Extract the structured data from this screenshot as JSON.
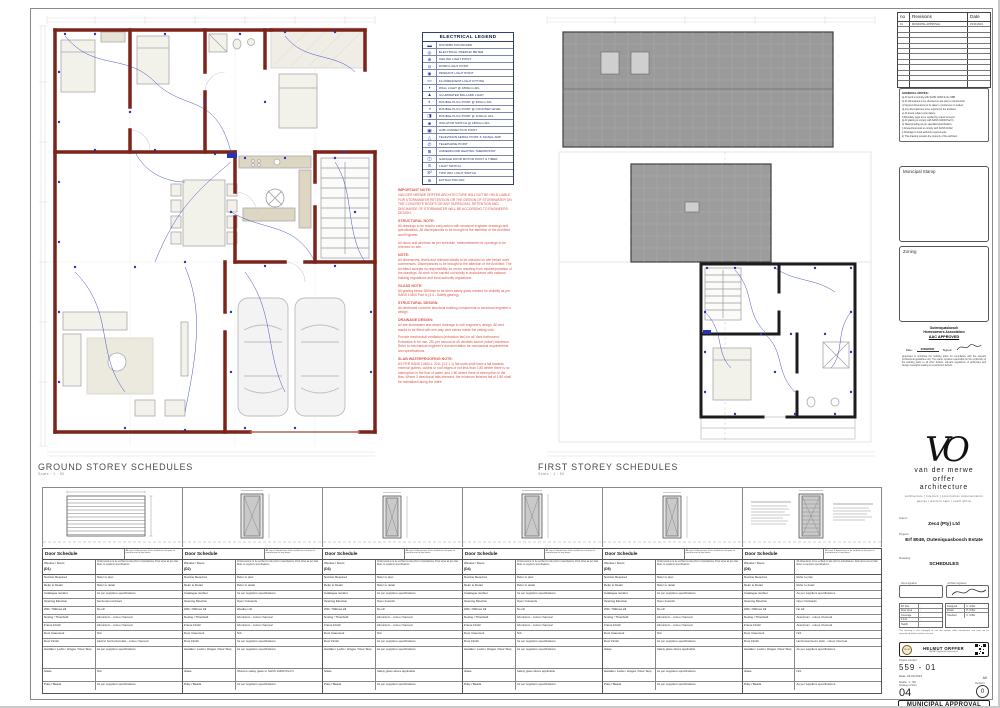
{
  "plans": {
    "ground_title": "GROUND STOREY SCHEDULES",
    "ground_scale": "Scale : 1 : 50",
    "first_title": "FIRST STOREY SCHEDULES",
    "first_scale": "Scale : 1 : 50"
  },
  "legend": {
    "title": "ELECTRICAL LEGEND",
    "rows": [
      {
        "glyph": "▬",
        "label": "DISTRIBUTION BOARD"
      },
      {
        "glyph": "◎",
        "label": "ELECTRICAL PREPAID METER"
      },
      {
        "glyph": "⊕",
        "label": "CEILING LIGHT POINT"
      },
      {
        "glyph": "⊙",
        "label": "DOWN LIGHT POINT"
      },
      {
        "glyph": "◉",
        "label": "PENDANT LIGHT POINT"
      },
      {
        "glyph": "▭",
        "label": "FLUORESCENT LIGHT FITTING"
      },
      {
        "glyph": "◖",
        "label": "WALL LIGHT @ 1800mm AFL"
      },
      {
        "glyph": "▲",
        "label": "ILLUMINATED BOLLARD LIGHT"
      },
      {
        "glyph": "◐",
        "label": "DOUBLE PLUG POINT @ 300mm AFL"
      },
      {
        "glyph": "◑",
        "label": "DOUBLE PLUG POINT @ COUNTER LEVEL"
      },
      {
        "glyph": "◨",
        "label": "DOUBLE PLUG POINT @ 1100mm AFL"
      },
      {
        "glyph": "■",
        "label": "ISOLATOR SWITCH @ 1800mm AFL"
      },
      {
        "glyph": "▣",
        "label": "HOB CONNECTION POINT"
      },
      {
        "glyph": "△",
        "label": "TELEVISION AERIAL POINT & SIGNAL AMP"
      },
      {
        "glyph": "✆",
        "label": "TELEPHONE POINT"
      },
      {
        "glyph": "⊞",
        "label": "UNDERFLOOR HEATING THERMOSTAT"
      },
      {
        "glyph": "◫",
        "label": "GARAGE DOOR MOTOR POINT & TIMER"
      },
      {
        "glyph": "S",
        "label": "LIGHT SWITCH"
      },
      {
        "glyph": "S²",
        "label": "TWO WAY LIGHT SWITCH"
      },
      {
        "glyph": "⊛",
        "label": "EXTRACTOR FAN"
      }
    ]
  },
  "notes": {
    "sections": [
      {
        "heading": "IMPORTANT NOTE:",
        "body": "VAN DER MERWE ORFFER ARCHITECTURE WILL NOT BE HELD LIABLE FOR STORMWATER RETENTION OR THE DESIGN OF STORMWATER ON THE CONCRETE ROOFS OR ANY SURFACING, RETENTION AND DISCHARGE OF STORMWATER WILL BE ACCORDING TO ENGINEERS DESIGN."
      },
      {
        "heading": "STRUCTURAL NOTE:",
        "body": "All drawings to be read in conjunction with structural engineer drawings and specifications. All discrepancies to be brought to the attention of the Architect and Engineer."
      },
      {
        "heading": "",
        "body": "All doors and windows as per schedule, measurements for openings to be checked on site."
      },
      {
        "heading": "NOTE:",
        "body": "All dimensions, levels and relevant details to be checked on site before work commences. Discrepancies to be brought to the attention of the Architect. The Architect accepts no responsibility for errors resulting from misinterpretation of the drawings. All work to be carried out strictly in accordance with national building regulations and local authority regulations."
      },
      {
        "heading": "GLASS NOTE:",
        "body": "All glazing below 1800mm to be 6mm safety glass marked for visibility as per SANS 10400 Part N (4.4 - Safety glazing)."
      },
      {
        "heading": "STRUCTURAL DESIGN:",
        "body": "All reinforced concrete structural building components to structural engineer's design."
      },
      {
        "heading": "DRAINAGE DESIGN:",
        "body": "All site stormwater and sewer drainage to civil engineer's design. All vent stacks to be fitted with one-way vent valves inside the ceiling void."
      },
      {
        "heading": "",
        "body": "Provide mechanical ventilation (extraction fan) for all 'dark bathrooms'. Extraction to be min. 25L per second at 45 decibels sound (noise) maximum. Refer to mechanical engineer's documentation for mechanical requirements and specifications."
      },
      {
        "heading": "SLAB WATERPROOFING NOTE:",
        "body": "AS PER SANS 10400-L 2011 (4.2.1.1) flat roofs shall have a fall towards external gutters, outlets or roof edges of not less than 1:80 where there is no interruption in the flow of water, and 1:50 where there is interruption in the flow. Where 2 directional falls intersect, the minimum finished fall of 1:80 shall be maintained along the mitre."
      }
    ]
  },
  "doors": [
    {
      "title": "Door Schedule",
      "code": "(D1)",
      "title_note": "All sizes & dimensions to be verified on site prior to manufacture of any doors.",
      "window_label": "Window / Doors",
      "note": "All dimensions to be verified on site prior to manufacture. Door sizes as per plan. Refer to suppliers specifications.",
      "rows": [
        {
          "l": "Number Required",
          "v": "Refer to plan"
        },
        {
          "l": "Refer to Detail",
          "v": "Refer to detail"
        },
        {
          "l": "Catalogue number",
          "v": "As per suppliers specifications"
        },
        {
          "l": "Opening Direction",
          "v": "Sectional overhead"
        },
        {
          "l": "With / Without sill",
          "v": "No sill"
        },
        {
          "l": "Nosing / Threshold",
          "v": "Aluminium - colour charcoal"
        },
        {
          "l": "Frame Finish",
          "v": "Aluminium - colour charcoal"
        },
        {
          "l": "Door Casement",
          "v": "N/A"
        },
        {
          "l": "Door Finish",
          "v": "Aluzinc horizontal slats - colour charcoal"
        },
        {
          "l": "Handles / Locks / Hinges / Door Stop",
          "v": "As per suppliers specifications"
        },
        {
          "l": "Glass",
          "v": "N/A"
        },
        {
          "l": "Putty / Beads",
          "v": "As per suppliers specifications"
        }
      ]
    },
    {
      "title": "Door Schedule",
      "code": "(D2)",
      "title_note": "All sizes & dimensions to be verified on site prior to manufacture of any doors.",
      "window_label": "Window / Doors",
      "note": "All dimensions to be verified on site prior to manufacture. Door sizes as per plan. Refer to suppliers specifications.",
      "rows": [
        {
          "l": "Number Required",
          "v": "Refer to plan"
        },
        {
          "l": "Refer to Detail",
          "v": "Refer to detail"
        },
        {
          "l": "Catalogue number",
          "v": "As per suppliers specifications"
        },
        {
          "l": "Opening Direction",
          "v": "Open Outwards"
        },
        {
          "l": "With / Without sill",
          "v": "Weather sill"
        },
        {
          "l": "Nosing / Threshold",
          "v": "Aluminium - colour charcoal"
        },
        {
          "l": "Frame Finish",
          "v": "Aluminium - colour charcoal"
        },
        {
          "l": "Door Casement",
          "v": "N/A"
        },
        {
          "l": "Door Finish",
          "v": "As per suppliers specifications"
        },
        {
          "l": "Handles / Locks / Hinges / Door Stop",
          "v": "As per suppliers specifications"
        },
        {
          "l": "Glass",
          "v": "Obscure safety glass to SANS 10400 Part N"
        },
        {
          "l": "Putty / Beads",
          "v": "As per suppliers specifications"
        }
      ]
    },
    {
      "title": "Door Schedule",
      "code": "(D3)",
      "title_note": "All sizes & dimensions to be verified on site prior to manufacture of any doors.",
      "window_label": "Window / Doors",
      "note": "All dimensions to be verified on site prior to manufacture. Door sizes as per plan. Refer to suppliers specifications.",
      "rows": [
        {
          "l": "Number Required",
          "v": "Refer to plan"
        },
        {
          "l": "Refer to Detail",
          "v": "Refer to detail"
        },
        {
          "l": "Catalogue number",
          "v": "As per suppliers specifications"
        },
        {
          "l": "Opening Direction",
          "v": "Open Inwards"
        },
        {
          "l": "With / Without sill",
          "v": "No sill"
        },
        {
          "l": "Nosing / Threshold",
          "v": "Aluminium - colour charcoal"
        },
        {
          "l": "Frame Finish",
          "v": "Aluminium - colour charcoal"
        },
        {
          "l": "Door Casement",
          "v": "N/A"
        },
        {
          "l": "Door Finish",
          "v": "As per suppliers specifications"
        },
        {
          "l": "Handles / Locks / Hinges / Door Stop",
          "v": "As per suppliers specifications"
        },
        {
          "l": "Glass",
          "v": "Safety glass where applicable"
        },
        {
          "l": "Putty / Beads",
          "v": "As per suppliers specifications"
        }
      ]
    },
    {
      "title": "Door Schedule",
      "code": "(D4)",
      "title_note": "All sizes & dimensions to be verified on site prior to manufacture of any doors.",
      "window_label": "Window / Doors",
      "note": "All dimensions to be verified on site prior to manufacture. Door sizes as per plan. Refer to suppliers specifications.",
      "rows": [
        {
          "l": "Number Required",
          "v": "Refer to plan"
        },
        {
          "l": "Refer to Detail",
          "v": "Refer to detail"
        },
        {
          "l": "Catalogue number",
          "v": "As per suppliers specifications"
        },
        {
          "l": "Opening Direction",
          "v": "Open Outwards"
        },
        {
          "l": "With / Without sill",
          "v": "No sill"
        },
        {
          "l": "Nosing / Threshold",
          "v": "Aluminium - colour charcoal"
        },
        {
          "l": "Frame Finish",
          "v": "Aluminium - colour charcoal"
        },
        {
          "l": "Door Casement",
          "v": "N/A"
        },
        {
          "l": "Door Finish",
          "v": "As per suppliers specifications"
        },
        {
          "l": "Handles / Locks / Hinges / Door Stop",
          "v": "As per suppliers specifications"
        },
        {
          "l": "Glass",
          "v": "Safety glass where applicable"
        },
        {
          "l": "Putty / Beads",
          "v": "As per suppliers specifications"
        }
      ]
    },
    {
      "title": "Door Schedule",
      "code": "(D5)",
      "title_note": "All sizes & dimensions to be verified on site prior to manufacture of any doors.",
      "window_label": "Window / Doors",
      "note": "All dimensions to be verified on site prior to manufacture. Door sizes as per plan. Refer to suppliers specifications.",
      "rows": [
        {
          "l": "Number Required",
          "v": "Refer to plan"
        },
        {
          "l": "Refer to Detail",
          "v": "Refer to detail"
        },
        {
          "l": "Catalogue number",
          "v": "As per suppliers specifications"
        },
        {
          "l": "Opening Direction",
          "v": "Open Inwards"
        },
        {
          "l": "With / Without sill",
          "v": "No sill"
        },
        {
          "l": "Nosing / Threshold",
          "v": "Aluminium - colour charcoal"
        },
        {
          "l": "Frame Finish",
          "v": "Aluminium - colour charcoal"
        },
        {
          "l": "Door Casement",
          "v": "N/A"
        },
        {
          "l": "Door Finish",
          "v": "As per suppliers specifications"
        },
        {
          "l": "Glass",
          "v": "Safety glass where applicable"
        },
        {
          "l": "Handles / Locks / Hinges / Door Stop",
          "v": "As per suppliers specifications"
        },
        {
          "l": "Putty / Beads",
          "v": "As per suppliers specifications"
        }
      ]
    },
    {
      "title": "Door Schedule",
      "code": "(D6)",
      "title_note": "All sizes & dimensions to be verified on site prior to manufacture of any doors.",
      "window_label": "Window / Doors",
      "note": "All dimensions to be verified on site prior to manufacture. Door sizes as per plan. Refer to suppliers specifications.",
      "rows": [
        {
          "l": "Number Required",
          "v": "Refer to plan"
        },
        {
          "l": "Refer to Detail",
          "v": "Refer to detail"
        },
        {
          "l": "Catalogue number",
          "v": "As per suppliers specifications"
        },
        {
          "l": "Opening Direction",
          "v": "Open Outwards"
        },
        {
          "l": "With / Without sill",
          "v": "No sill"
        },
        {
          "l": "Nosing / Threshold",
          "v": "Aluminium - colour charcoal"
        },
        {
          "l": "Frame Finish",
          "v": "Aluminium - colour charcoal"
        },
        {
          "l": "Door Casement",
          "v": "N/A"
        },
        {
          "l": "Door Finish",
          "v": "Horizontal louvre slats - colour charcoal"
        },
        {
          "l": "Handles / Locks / Hinges / Door Stop",
          "v": "As per suppliers specifications"
        },
        {
          "l": "Glass",
          "v": "N/A"
        },
        {
          "l": "Putty / Beads",
          "v": "As per suppliers specifications"
        }
      ]
    }
  ],
  "titleblock": {
    "revisions": {
      "no_h": "no",
      "rev_h": "Revisions",
      "date_h": "Date",
      "rows": [
        {
          "no": "01",
          "rev": "MUNICIPAL APPROVAL",
          "date": "23.09.2021"
        }
      ],
      "empty_rows": [
        "",
        "",
        "",
        "",
        "",
        "",
        "",
        "",
        "",
        "",
        ""
      ]
    },
    "general_notes_heading": "GENERAL NOTES:",
    "general_notes": [
      "a) All work to comply with SANS 10400 & the NBR.",
      "b) All dimensions to be checked on site prior to construction.",
      "c) Figured dimensions to be taken in preference to scaled.",
      "d) Any discrepancies to be reported to the architect.",
      "e) All levels relate to site datum.",
      "f) Boundary pegs to be verified by a land surveyor.",
      "g) All glazing to comply with SANS 10400 Part N.",
      "h) Waterproofing as per specialist specification.",
      "i) All electrical work to comply with SANS 10142.",
      "j) Drainage to local authority requirements.",
      "k) This drawing remains the property of the architect."
    ],
    "municipal_stamp_label": "Municipal Stamp",
    "zoning_label": "Zoning",
    "hoa": {
      "line1": "Outeniquasbosch",
      "line2": "Homeowners Association",
      "line3": "AAC APPROVED",
      "date_label": "Date:",
      "date": "23/09/2021",
      "signed_label": "Signed:",
      "disclaimer": "Appointed to scrutinise the building plans for compliance with the relevant architectural guidelines only. The owner remains responsible for the conformity of the building plans to all other bylaws, relevant regulations of authorities and design oversights leading to construction defects."
    },
    "firm": {
      "monogram": "VO",
      "name1": "van der merwe",
      "name2": "orffer",
      "name3": "architecture",
      "tagline": "architecture | interiors | construction documentation",
      "contact": "george | western cape | south africa"
    },
    "client_label": "Client:",
    "client": "Zec4 (Pty) Ltd",
    "project_label": "Project:",
    "project": "Erf 8049, Outeniquasbosch Estate",
    "drawing_label": "Drawing:",
    "drawing": "SCHEDULES",
    "sign": {
      "client_cap": "Client signature",
      "architect_cap": "Architect signature"
    },
    "info_left": [
      {
        "l": "Erf Size",
        "v": "-"
      },
      {
        "l": "Floor Area",
        "v": "-"
      },
      {
        "l": "Coverage",
        "v": "-"
      },
      {
        "l": "F.A.R.",
        "v": "-"
      },
      {
        "l": "Height",
        "v": "-"
      }
    ],
    "info_right": [
      {
        "l": "Designed",
        "v": "C. Orffer"
      },
      {
        "l": "Drawn",
        "v": "H. Orffer"
      },
      {
        "l": "Checked",
        "v": "C. Orffer"
      }
    ],
    "tb_disclaimer": "This drawing is the copyright of van der merwe orffer architecture and may not be reproduced without written consent.",
    "banner": {
      "name": "HELMUT ORFFER",
      "sub": "SACAP Registered Professional",
      "roundel": "SACAP"
    },
    "project_no_label": "Project number:",
    "project_no": "559 - 01",
    "date_label": "Date:",
    "date": "23.09.2021",
    "scale_label": "Scale:",
    "scale": "1 : 50",
    "paper": "A0",
    "drawing_no_label": "Drawing number:",
    "drawing_no": "04",
    "revision_label": "Revision:",
    "revision": "0",
    "municipal_banner": "MUNICIPAL APPROVAL"
  },
  "colors": {
    "wall_red": "#7c241a",
    "electric_blue": "#2634b8",
    "roof_grey": "#9a9a9a",
    "note_red": "#d9564a"
  }
}
